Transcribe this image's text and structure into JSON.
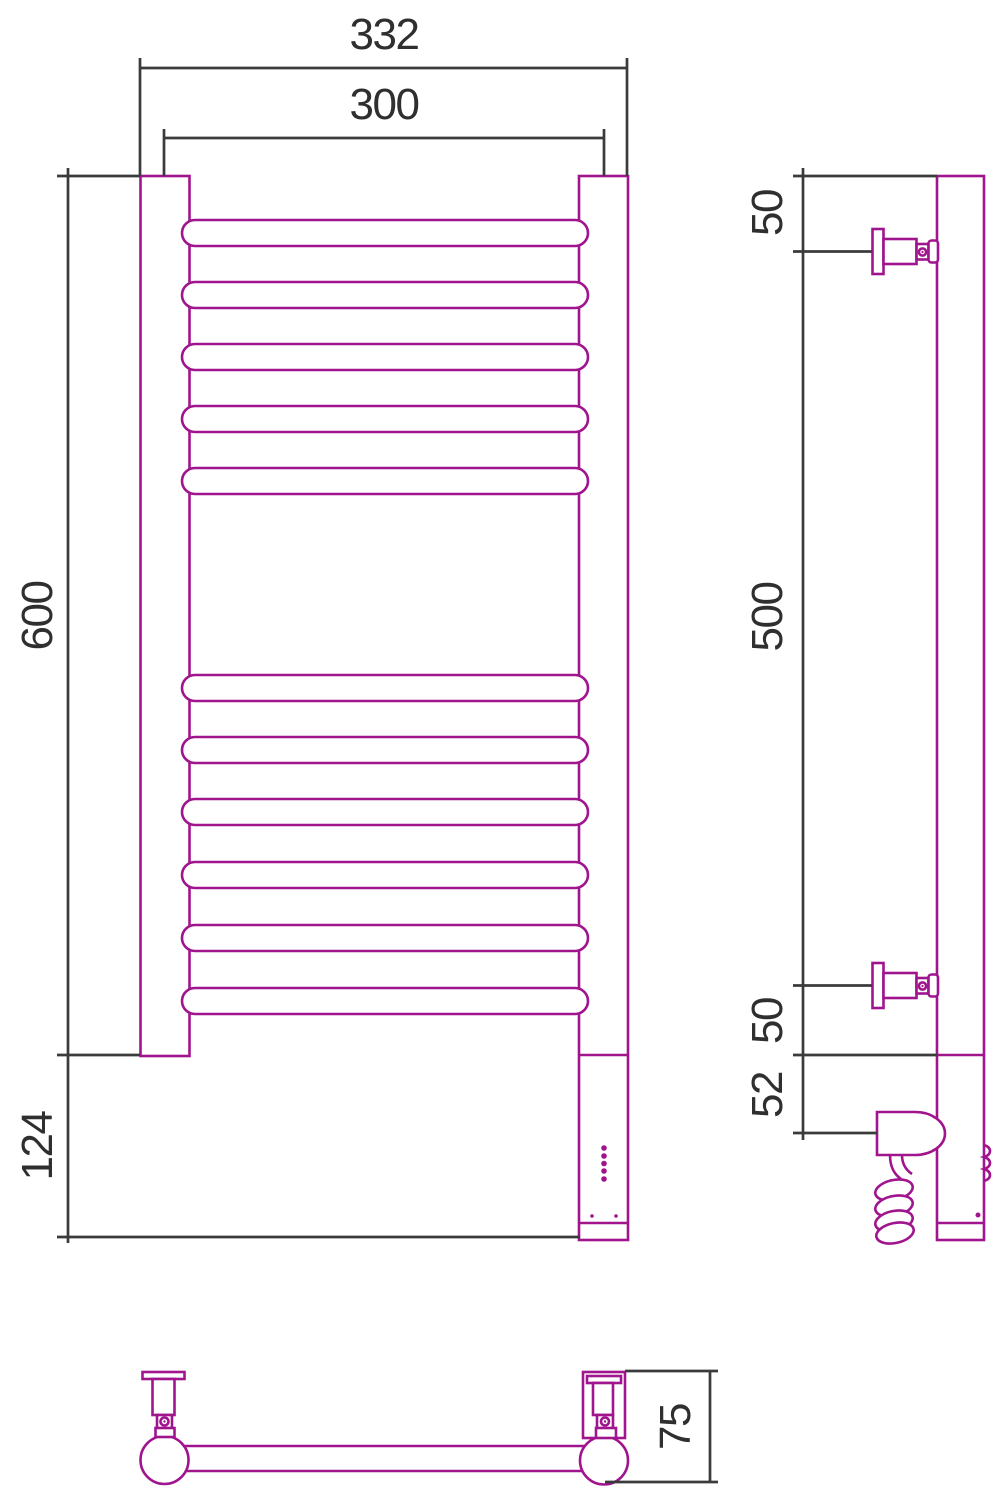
{
  "drawing": {
    "type": "technical-drawing",
    "subject": "wall-mounted electric heated towel rail, three orthographic views",
    "colors": {
      "product_outline": "#A0148E",
      "dimension_lines": "#3B3B3B",
      "text": "#2F2F2F",
      "background": "#FFFFFF"
    },
    "front_view": {
      "rung_count": 11,
      "rung_groups": [
        5,
        6
      ],
      "led_indicator_dots": 5,
      "dims": {
        "overall_width": "332",
        "axis_width": "300",
        "height": "600",
        "lower_section_height": "124"
      }
    },
    "side_view": {
      "wall_brackets": 2,
      "dims": {
        "top_bracket_offset": "50",
        "bracket_spacing": "500",
        "bottom_bracket_offset": "50",
        "heater_unit_offset": "52"
      }
    },
    "bottom_view": {
      "dims": {
        "depth": "75"
      }
    }
  }
}
